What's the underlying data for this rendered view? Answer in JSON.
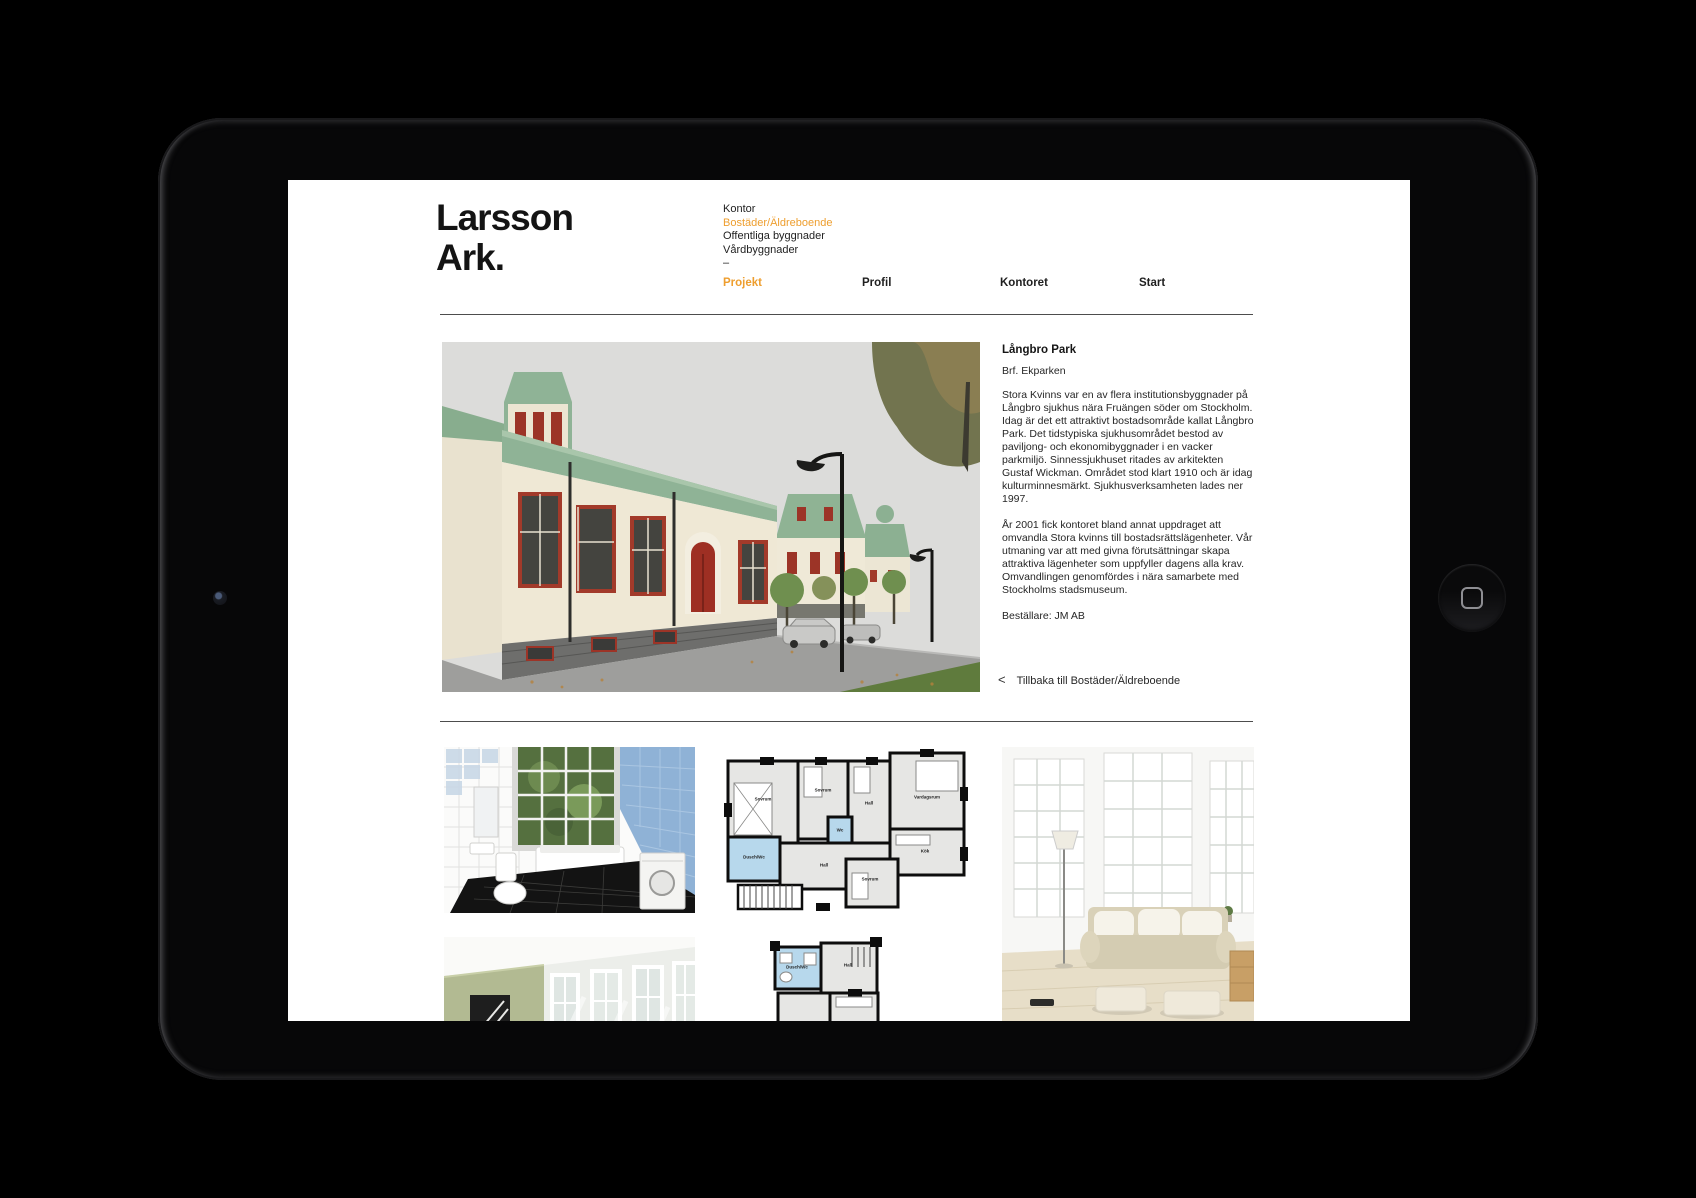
{
  "brand": {
    "line1": "Larsson",
    "line2": "Ark."
  },
  "category_nav": {
    "items": [
      {
        "label": "Kontor",
        "active": false
      },
      {
        "label": "Bostäder/Äldreboende",
        "active": true
      },
      {
        "label": "Offentliga byggnader",
        "active": false
      },
      {
        "label": "Vårdbyggnader",
        "active": false
      }
    ],
    "divider": "–"
  },
  "main_nav": {
    "items": [
      {
        "label": "Projekt",
        "active": true
      },
      {
        "label": "Profil",
        "active": false
      },
      {
        "label": "Kontoret",
        "active": false
      },
      {
        "label": "Start",
        "active": false
      }
    ]
  },
  "project": {
    "title": "Långbro Park",
    "subtitle": "Brf. Ekparken",
    "paragraph1": "Stora Kvinns var en av flera institutionsbyggnader på Långbro sjukhus nära Fruängen söder om Stockholm. Idag är det ett attraktivt bostadsområde kallat Långbro Park. Det tidstypiska sjukhusområdet bestod av paviljong- och ekonomibyggnader i en vacker parkmiljö. Sinnessjukhuset ritades av arkitekten Gustaf Wickman. Området stod klart 1910 och är idag kulturminnesmärkt. Sjukhusverksamheten lades ner 1997.",
    "paragraph2": "År 2001 fick kontoret bland annat uppdraget att omvandla Stora kvinns till bostadsrättslägenheter. Vår utmaning var att med givna förutsättningar skapa attraktiva lägenheter som uppfyller dagens alla krav. Omvandlingen genomfördes i nära samarbete med Stockholms stadsmuseum.",
    "client": "Beställare: JM AB",
    "back_link": {
      "chevron": "<",
      "label": "Tillbaka till Bostäder/Äldreboende"
    }
  },
  "floorplans": {
    "plan1_rooms": [
      "Sovrum",
      "Sovrum",
      "Wc",
      "Hall",
      "Vardagsrum",
      "Dusch/Wc",
      "Hall",
      "Kök",
      "Sovrum"
    ],
    "plan2_rooms": [
      "Dusch/Wc",
      "Hall",
      "Kök",
      "Klk"
    ]
  },
  "colors": {
    "accent_orange": "#ee9e2e",
    "rule_gray": "#4d4d4d",
    "roof_green": "#8fb396",
    "window_red": "#a23a2a",
    "tile_blue": "#92b4d8",
    "wall_sage": "#b2ba92"
  }
}
